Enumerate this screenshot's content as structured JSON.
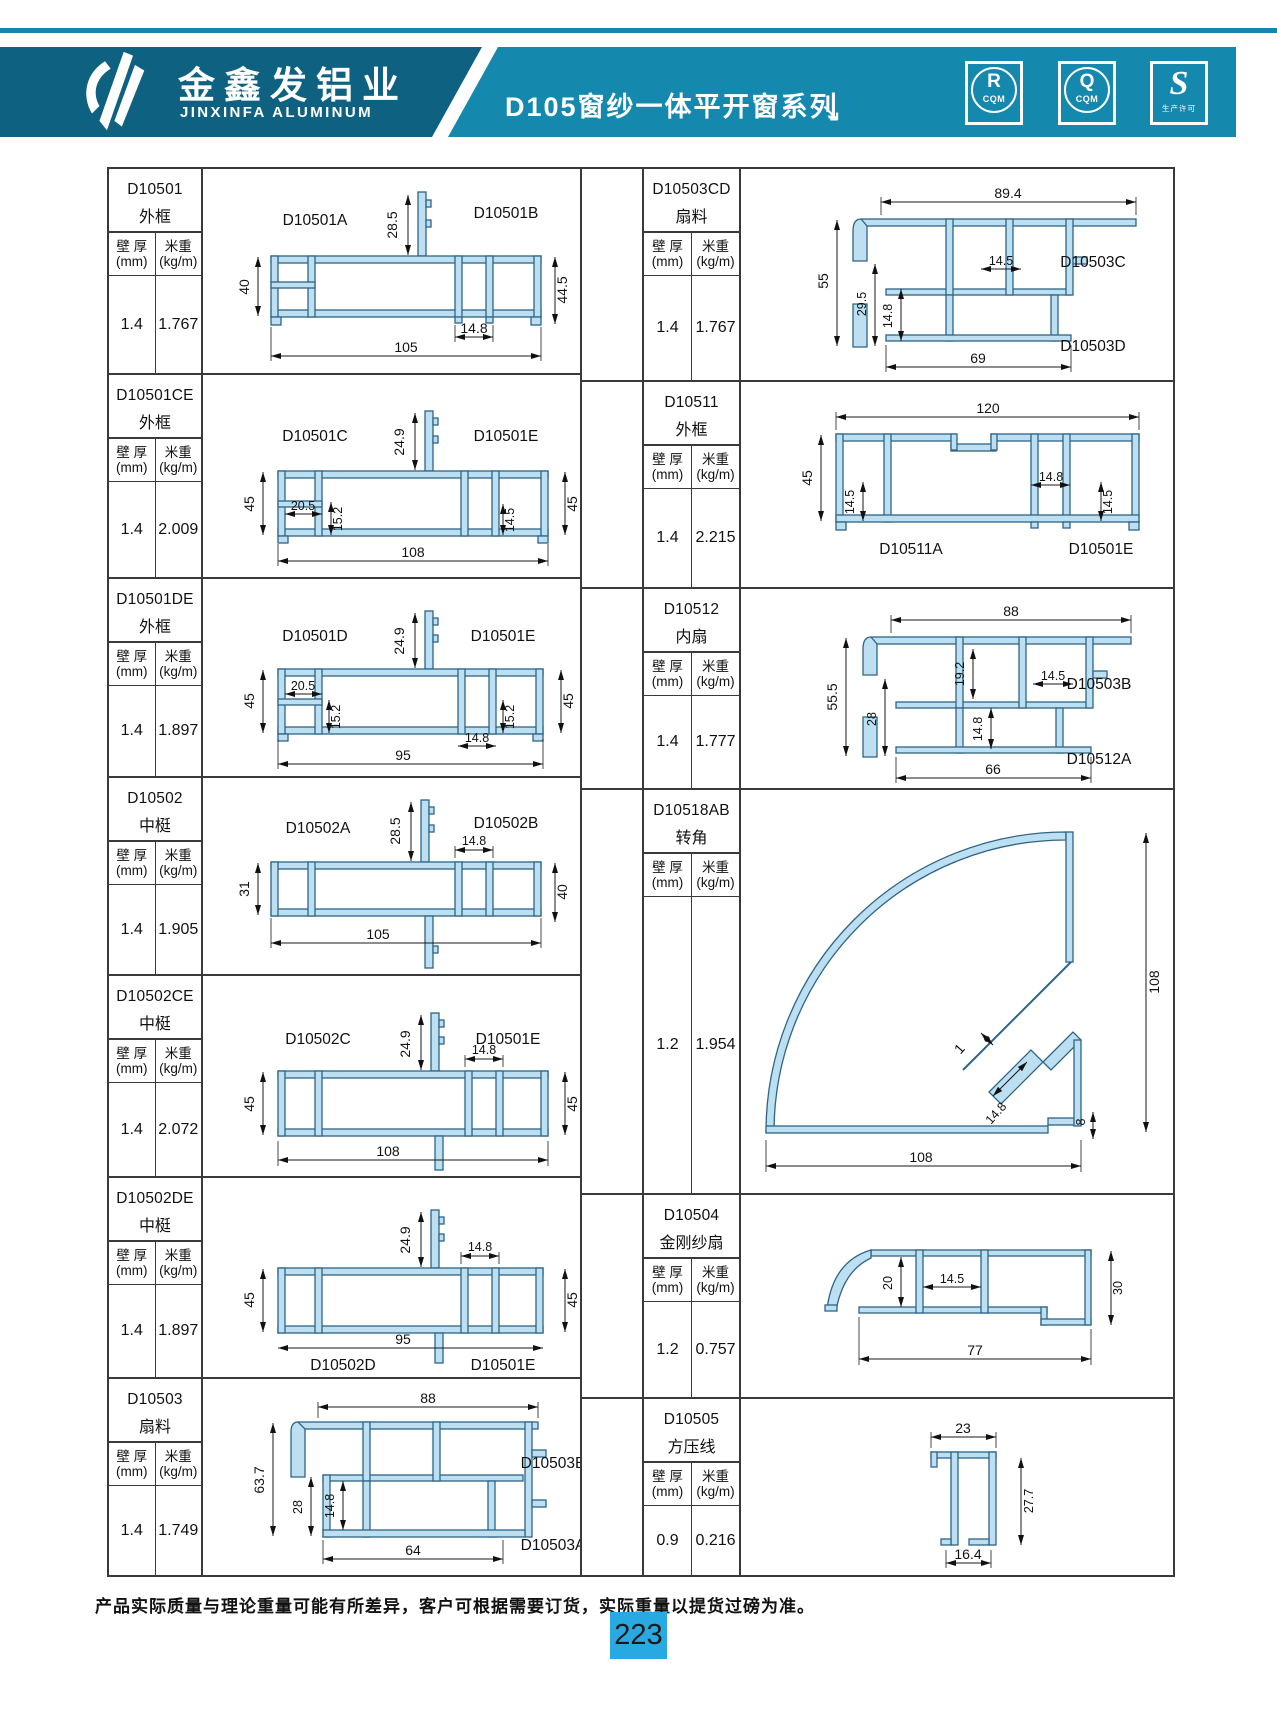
{
  "header": {
    "brand_cn": "金鑫发铝业",
    "brand_en": "JINXINFA ALUMINUM",
    "series_title": "D105窗纱一体平开窗系列",
    "arrow": "↘",
    "badges": [
      {
        "letter": "R",
        "sub": "CQM"
      },
      {
        "letter": "Q",
        "sub": "CQM"
      },
      {
        "letter": "S",
        "sub": "生产许可"
      }
    ]
  },
  "table": {
    "labels": {
      "wall": "壁 厚",
      "wall_u": "(mm)",
      "weight": "米重",
      "weight_u": "(kg/m)"
    },
    "left_rows": [
      {
        "code": "D10501",
        "type": "外框",
        "wall": "1.4",
        "weight": "1.767",
        "drawing": {
          "partA": "D10501A",
          "partB": "D10501B",
          "fin": "28.5",
          "left": "40",
          "right": "44.5",
          "slot": "14.8",
          "width": "105"
        }
      },
      {
        "code": "D10501CE",
        "type": "外框",
        "wall": "1.4",
        "weight": "2.009",
        "drawing": {
          "partA": "D10501C",
          "partB": "D10501E",
          "fin": "24.9",
          "left": "45",
          "right": "45",
          "d1": "20.5",
          "d2": "15.2",
          "d3": "14.5",
          "width": "108"
        }
      },
      {
        "code": "D10501DE",
        "type": "外框",
        "wall": "1.4",
        "weight": "1.897",
        "drawing": {
          "partA": "D10501D",
          "partB": "D10501E",
          "fin": "24.9",
          "d1": "20.5",
          "left": "45",
          "d2": "15.2",
          "d3": "15.2",
          "slot": "14.8",
          "width": "95",
          "right": "45"
        }
      },
      {
        "code": "D10502",
        "type": "中梃",
        "wall": "1.4",
        "weight": "1.905",
        "drawing": {
          "partA": "D10502A",
          "partB": "D10502B",
          "fin": "28.5",
          "slot": "14.8",
          "left": "31",
          "right": "40",
          "width": "105"
        }
      },
      {
        "code": "D10502CE",
        "type": "中梃",
        "wall": "1.4",
        "weight": "2.072",
        "drawing": {
          "partA": "D10502C",
          "partB": "D10501E",
          "fin": "24.9",
          "slot": "14.8",
          "left": "45",
          "right": "45",
          "width": "108"
        }
      },
      {
        "code": "D10502DE",
        "type": "中梃",
        "wall": "1.4",
        "weight": "1.897",
        "drawing": {
          "partA": "D10502D",
          "partB": "D10501E",
          "fin": "24.9",
          "slot": "14.8",
          "left": "45",
          "right": "45",
          "width": "95"
        }
      },
      {
        "code": "D10503",
        "type": "扇料",
        "wall": "1.4",
        "weight": "1.749",
        "drawing": {
          "top": "88",
          "left": "63.7",
          "d1": "28",
          "slot": "14.8",
          "width": "64",
          "partA": "D10503B",
          "partB": "D10503A"
        }
      }
    ],
    "right_rows": [
      {
        "code": "D10503CD",
        "type": "扇料",
        "wall": "1.4",
        "weight": "1.767",
        "drawing": {
          "top": "89.4",
          "left": "55",
          "d1": "29.5",
          "slot": "14.8",
          "d2": "14.5",
          "width": "69",
          "partA": "D10503C",
          "partB": "D10503D"
        }
      },
      {
        "code": "D10511",
        "type": "外框",
        "wall": "1.4",
        "weight": "2.215",
        "drawing": {
          "top": "120",
          "left": "45",
          "d1": "14.5",
          "slot": "14.8",
          "d2": "14.5",
          "partA": "D10511A",
          "partB": "D10501E"
        }
      },
      {
        "code": "D10512",
        "type": "内扇",
        "wall": "1.4",
        "weight": "1.777",
        "drawing": {
          "top": "88",
          "left": "55.5",
          "d1": "28",
          "d2": "19.2",
          "d3": "14.5",
          "slot": "14.8",
          "width": "66",
          "partA": "D10503B",
          "partB": "D10512A"
        }
      },
      {
        "code": "D10518AB",
        "type": "转角",
        "wall": "1.2",
        "weight": "1.954",
        "drawing": {
          "right": "108",
          "t": "1",
          "slot": "14.8",
          "d1": "8",
          "width": "108"
        }
      },
      {
        "code": "D10504",
        "type": "金刚纱扇",
        "wall": "1.2",
        "weight": "0.757",
        "drawing": {
          "d1": "20",
          "d2": "14.5",
          "right": "30",
          "width": "77"
        }
      },
      {
        "code": "D10505",
        "type": "方压线",
        "wall": "0.9",
        "weight": "0.216",
        "drawing": {
          "top": "23",
          "right": "27.7",
          "width": "16.4"
        }
      }
    ]
  },
  "footer": {
    "note": "产品实际质量与理论重量可能有所差异，客户可根据需要订货，实际重量以提货过磅为准。",
    "page": "223"
  }
}
